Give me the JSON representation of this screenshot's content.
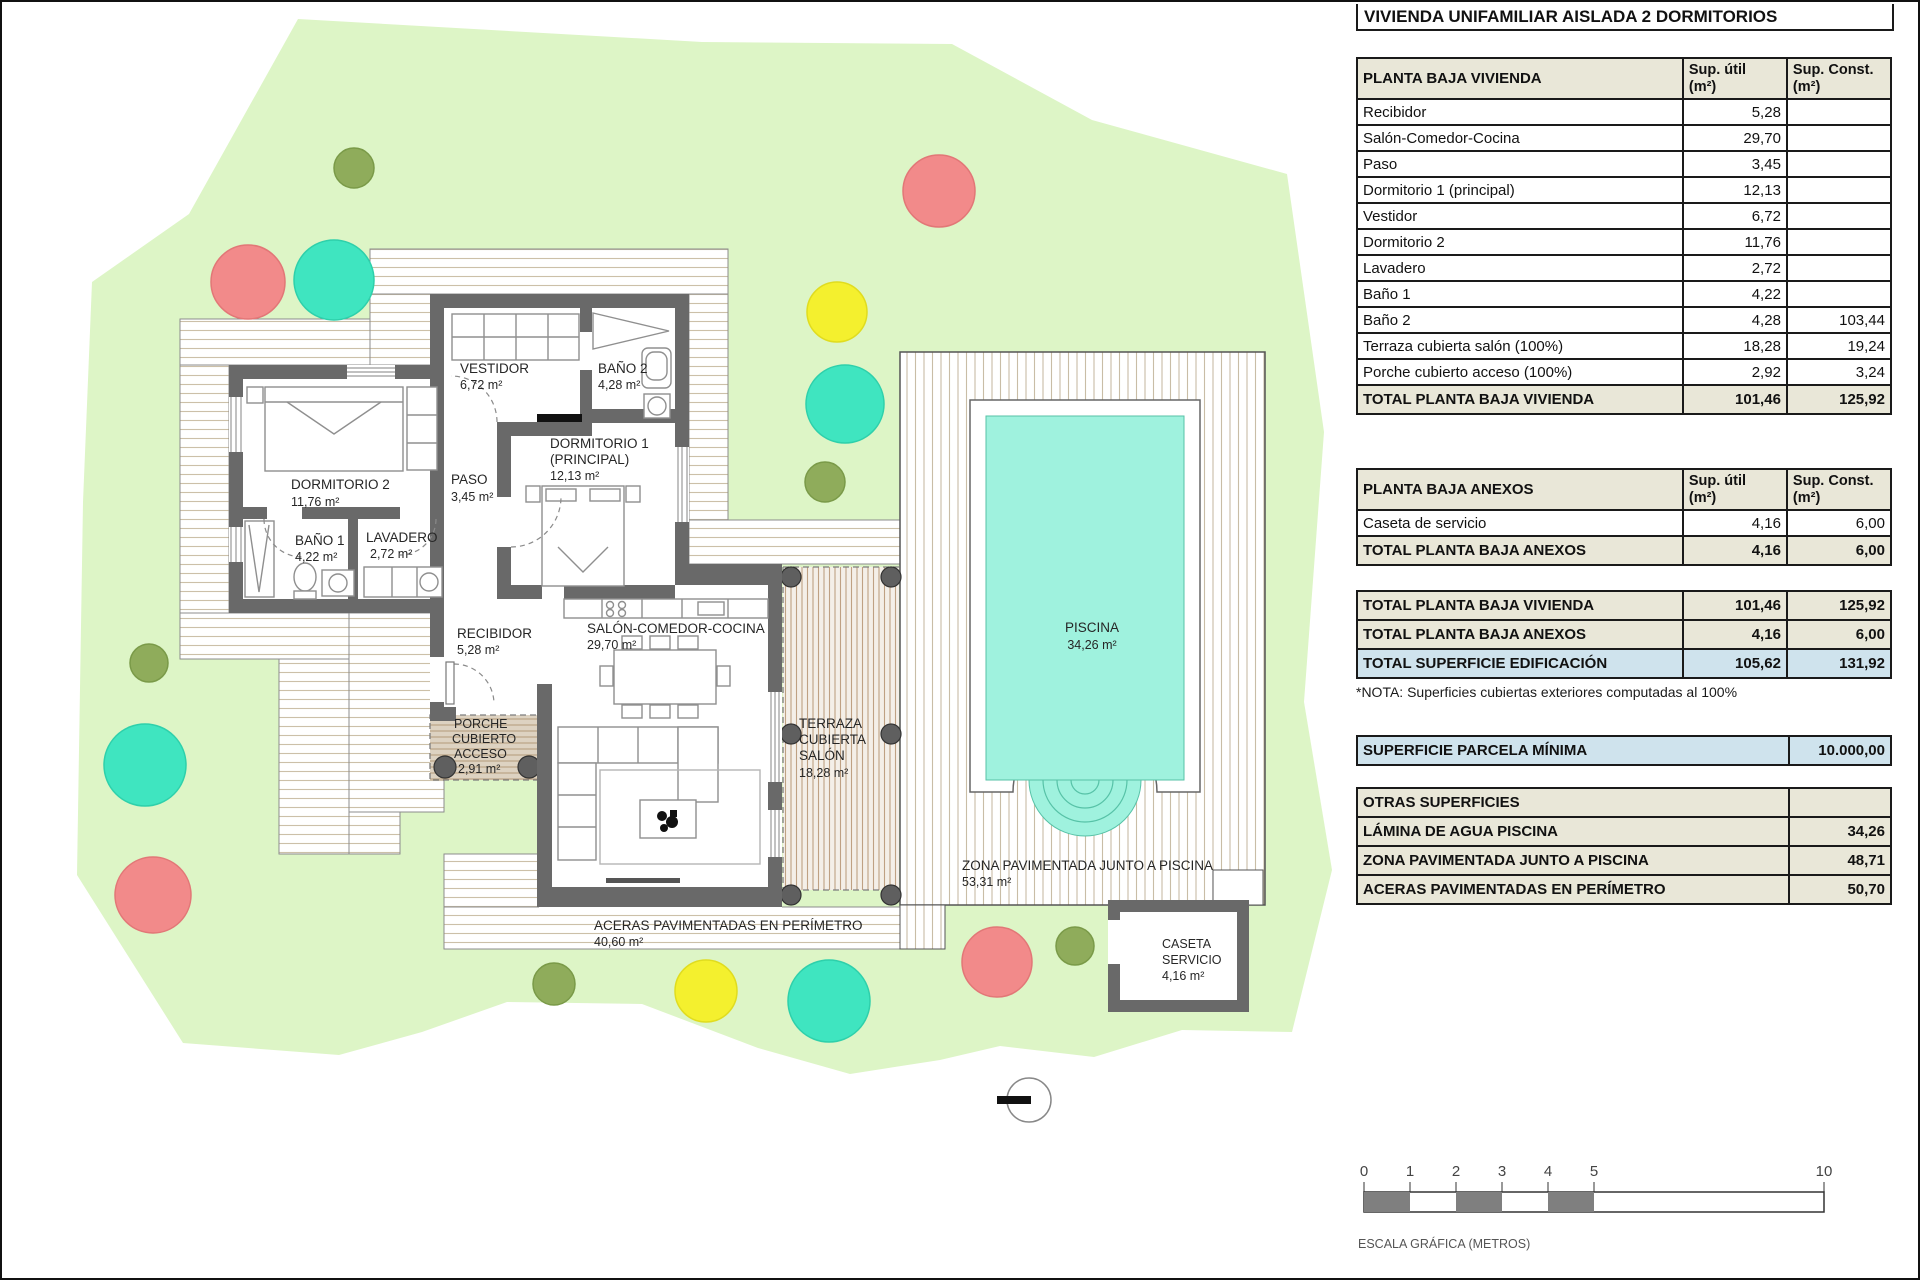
{
  "panel": {
    "title": "VIVIENDA UNIFAMILIAR AISLADA 2 DORMITORIOS",
    "headers": {
      "util": "Sup. útil",
      "konst": "Sup. Const.",
      "unit": "(m²)"
    },
    "vivienda": {
      "title": "PLANTA BAJA VIVIENDA",
      "rows": [
        {
          "label": "Recibidor",
          "util": "5,28",
          "konst": ""
        },
        {
          "label": "Salón-Comedor-Cocina",
          "util": "29,70",
          "konst": ""
        },
        {
          "label": "Paso",
          "util": "3,45",
          "konst": ""
        },
        {
          "label": "Dormitorio 1 (principal)",
          "util": "12,13",
          "konst": ""
        },
        {
          "label": "Vestidor",
          "util": "6,72",
          "konst": ""
        },
        {
          "label": "Dormitorio 2",
          "util": "11,76",
          "konst": ""
        },
        {
          "label": "Lavadero",
          "util": "2,72",
          "konst": ""
        },
        {
          "label": "Baño 1",
          "util": "4,22",
          "konst": ""
        },
        {
          "label": "Baño 2",
          "util": "4,28",
          "konst": "103,44"
        },
        {
          "label": "Terraza cubierta salón (100%)",
          "util": "18,28",
          "konst": "19,24"
        },
        {
          "label": "Porche cubierto acceso (100%)",
          "util": "2,92",
          "konst": "3,24"
        }
      ],
      "total": {
        "label": "TOTAL PLANTA BAJA VIVIENDA",
        "util": "101,46",
        "konst": "125,92"
      }
    },
    "anexos": {
      "title": "PLANTA BAJA ANEXOS",
      "rows": [
        {
          "label": "Caseta de servicio",
          "util": "4,16",
          "konst": "6,00"
        }
      ],
      "total": {
        "label": "TOTAL PLANTA BAJA ANEXOS",
        "util": "4,16",
        "konst": "6,00"
      }
    },
    "resumen": {
      "rows": [
        {
          "label": "TOTAL PLANTA BAJA VIVIENDA",
          "util": "101,46",
          "konst": "125,92"
        },
        {
          "label": "TOTAL PLANTA BAJA ANEXOS",
          "util": "4,16",
          "konst": "6,00"
        },
        {
          "label": "TOTAL SUPERFICIE EDIFICACIÓN",
          "util": "105,62",
          "konst": "131,92"
        }
      ]
    },
    "nota": "*NOTA: Superficies cubiertas exteriores computadas al 100%",
    "parcela": {
      "label": "SUPERFICIE PARCELA MÍNIMA",
      "value": "10.000,00"
    },
    "otras": {
      "title": "OTRAS SUPERFICIES",
      "rows": [
        {
          "label": "LÁMINA DE AGUA PISCINA",
          "value": "34,26"
        },
        {
          "label": "ZONA PAVIMENTADA JUNTO A PISCINA",
          "value": "48,71"
        },
        {
          "label": "ACERAS PAVIMENTADAS EN PERÍMETRO",
          "value": "50,70"
        }
      ]
    },
    "escala": {
      "t0": "0",
      "t1": "1",
      "t2": "2",
      "t3": "3",
      "t4": "4",
      "t5": "5",
      "t10": "10",
      "caption": "ESCALA GRÁFICA (METROS)"
    }
  },
  "plan": {
    "dormitorio2": {
      "name": "DORMITORIO 2",
      "area": "11,76 m²"
    },
    "bano1": {
      "name": "BAÑO 1",
      "area": "4,22 m²"
    },
    "lavadero": {
      "name": "LAVADERO",
      "area": "2,72 m²"
    },
    "paso": {
      "name": "PASO",
      "area": "3,45 m²"
    },
    "vestidor": {
      "name": "VESTIDOR",
      "area": "6,72 m²"
    },
    "bano2": {
      "name": "BAÑO 2",
      "area": "4,28 m²"
    },
    "dormitorio1": {
      "name": "DORMITORIO 1",
      "name2": "(PRINCIPAL)",
      "area": "12,13 m²"
    },
    "recibidor": {
      "name": "RECIBIDOR",
      "area": "5,28 m²"
    },
    "salon": {
      "name": "SALÓN-COMEDOR-COCINA",
      "area": "29,70 m²"
    },
    "porche": {
      "l1": "PORCHE",
      "l2": "CUBIERTO",
      "l3": "ACCESO",
      "area": "2,91 m²"
    },
    "terraza": {
      "l1": "TERRAZA",
      "l2": "CUBIERTA",
      "l3": "SALÓN",
      "area": "18,28 m²"
    },
    "aceras": {
      "name": "ACERAS PAVIMENTADAS EN PERÍMETRO",
      "area": "40,60 m²"
    },
    "piscina": {
      "name": "PISCINA",
      "area": "34,26 m²"
    },
    "zona": {
      "name": "ZONA PAVIMENTADA JUNTO A PISCINA",
      "area": "53,31 m²"
    },
    "caseta": {
      "l1": "CASETA",
      "l2": "SERVICIO",
      "area": "4,16 m²"
    }
  },
  "colors": {
    "parcel_green": "#ddf5c6",
    "wall_gray": "#696969",
    "pool_cyan": "#9ff2de",
    "tree_red": "#f28a8a",
    "tree_teal": "#3fe5c0",
    "tree_yellow": "#f4f02e",
    "tree_olive": "#8fac5b",
    "header_beige": "#e9e7d8",
    "highlight_blue": "#cfe3ed"
  }
}
